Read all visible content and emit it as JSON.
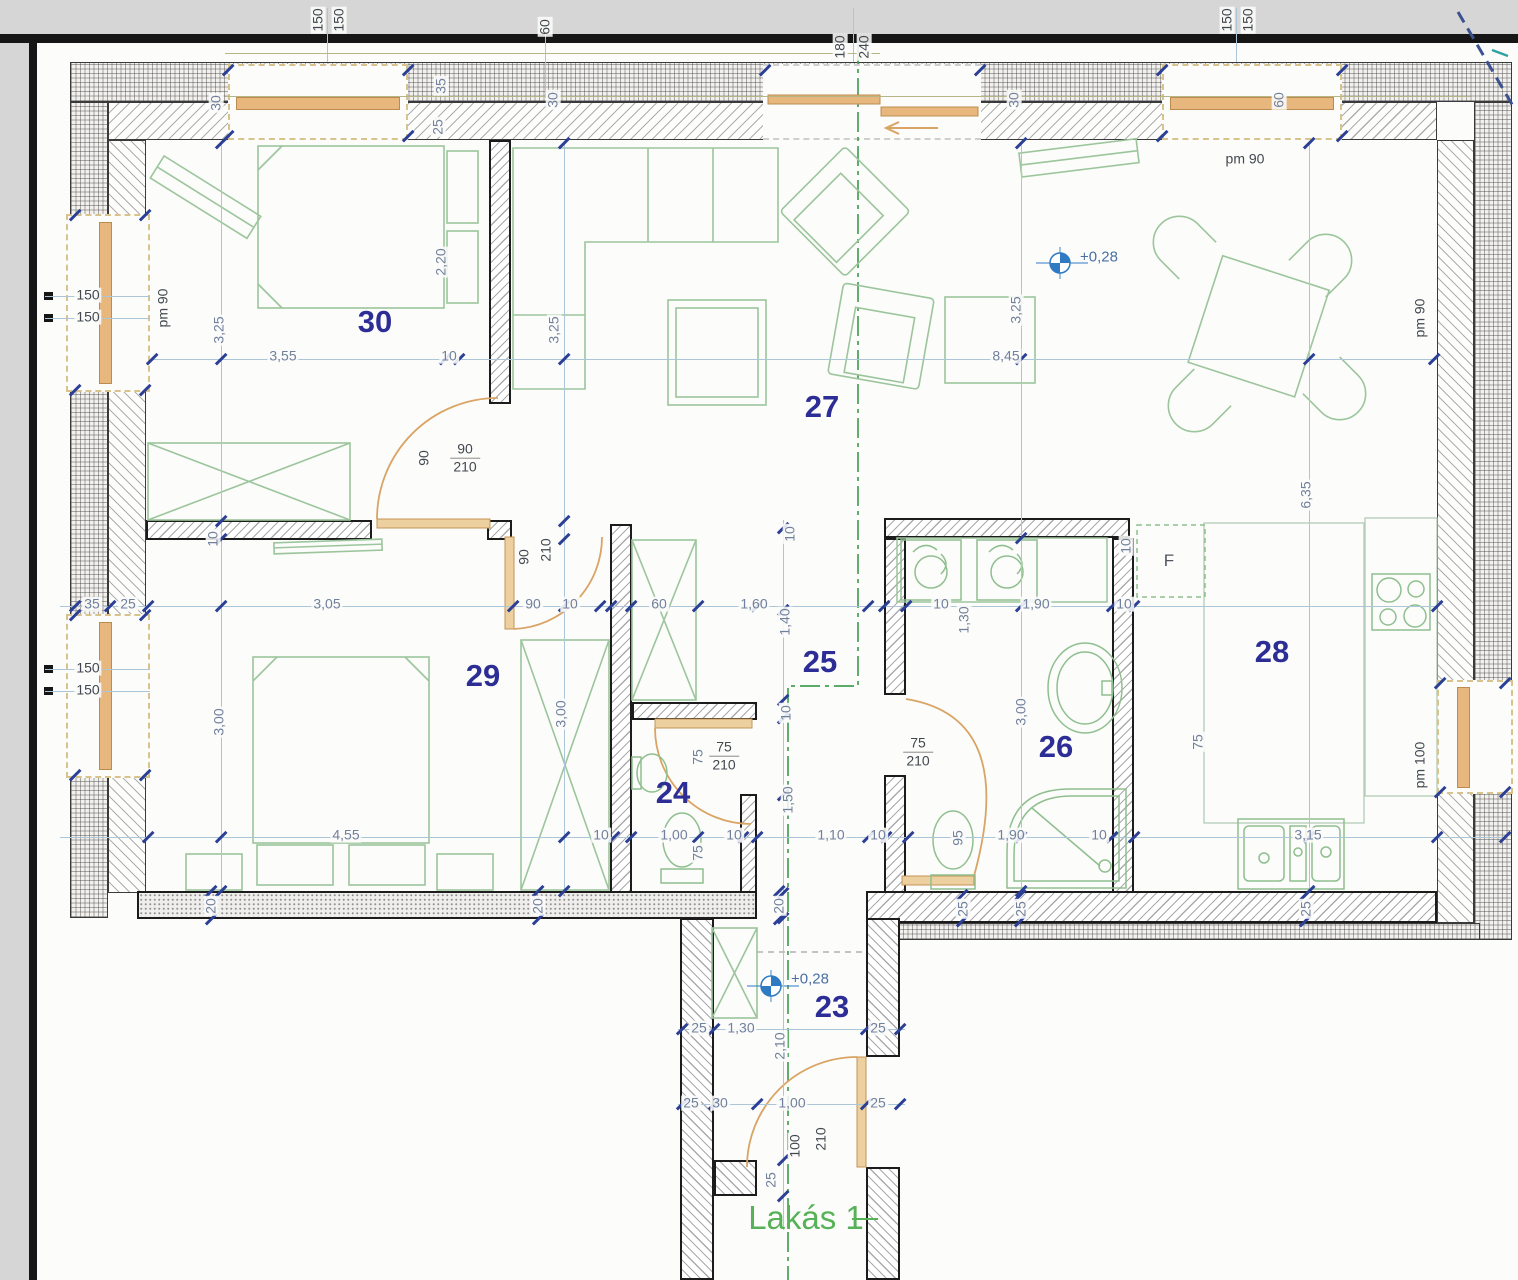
{
  "drawing": {
    "unit_label": "Lakás 1",
    "type": "apartment floor plan",
    "colors": {
      "dim_text": "#71809c",
      "dark_text": "#42484f",
      "room_number": "#2d2d96",
      "green": "#57b257",
      "door_orange": "#d9a464",
      "dim_line": "#aac6d8",
      "tick": "#2b3f96",
      "section_green": "#44a054"
    }
  },
  "rooms": [
    {
      "n": "30",
      "x": 375,
      "y": 322
    },
    {
      "n": "27",
      "x": 822,
      "y": 407
    },
    {
      "n": "29",
      "x": 483,
      "y": 676
    },
    {
      "n": "24",
      "x": 673,
      "y": 793
    },
    {
      "n": "25",
      "x": 820,
      "y": 662
    },
    {
      "n": "26",
      "x": 1056,
      "y": 747
    },
    {
      "n": "28",
      "x": 1272,
      "y": 652
    },
    {
      "n": "23",
      "x": 832,
      "y": 1007
    }
  ],
  "dim_labels": [
    {
      "t": "150",
      "x": 318,
      "y": 20,
      "v": 1,
      "c": "k"
    },
    {
      "t": "150",
      "x": 339,
      "y": 20,
      "v": 1,
      "c": "k"
    },
    {
      "t": "60",
      "x": 545,
      "y": 27,
      "v": 1,
      "c": "k"
    },
    {
      "t": "180",
      "x": 840,
      "y": 47,
      "v": 1,
      "c": "k"
    },
    {
      "t": "240",
      "x": 864,
      "y": 47,
      "v": 1,
      "c": "k"
    },
    {
      "t": "150",
      "x": 1227,
      "y": 20,
      "v": 1,
      "c": "k"
    },
    {
      "t": "150",
      "x": 1248,
      "y": 20,
      "v": 1,
      "c": "k"
    },
    {
      "t": "30",
      "x": 216,
      "y": 103,
      "v": 1
    },
    {
      "t": "35",
      "x": 441,
      "y": 86,
      "v": 1
    },
    {
      "t": "25",
      "x": 438,
      "y": 127,
      "v": 1
    },
    {
      "t": "30",
      "x": 553,
      "y": 100,
      "v": 1
    },
    {
      "t": "30",
      "x": 1014,
      "y": 100,
      "v": 1
    },
    {
      "t": "60",
      "x": 1279,
      "y": 100,
      "v": 1
    },
    {
      "t": "pm 90",
      "x": 1245,
      "y": 159,
      "c": "k"
    },
    {
      "t": "pm 90",
      "x": 163,
      "y": 308,
      "v": 1,
      "c": "k"
    },
    {
      "t": "pm 90",
      "x": 1420,
      "y": 318,
      "v": 1,
      "c": "k"
    },
    {
      "t": "150",
      "x": 88,
      "y": 295,
      "c": "k"
    },
    {
      "t": "150",
      "x": 88,
      "y": 317,
      "c": "k"
    },
    {
      "t": "150",
      "x": 88,
      "y": 668,
      "c": "k"
    },
    {
      "t": "150",
      "x": 88,
      "y": 690,
      "c": "k"
    },
    {
      "t": "3,25",
      "x": 219,
      "y": 330,
      "v": 1
    },
    {
      "t": "3,55",
      "x": 283,
      "y": 356
    },
    {
      "t": "10",
      "x": 449,
      "y": 356
    },
    {
      "t": "3,25",
      "x": 554,
      "y": 330,
      "v": 1
    },
    {
      "t": "8,45",
      "x": 1006,
      "y": 356
    },
    {
      "t": "3,25",
      "x": 1016,
      "y": 310,
      "v": 1
    },
    {
      "t": "2,20",
      "x": 441,
      "y": 262,
      "v": 1
    },
    {
      "t": "6,35",
      "x": 1306,
      "y": 495,
      "v": 1
    },
    {
      "t": "90",
      "x": 424,
      "y": 458,
      "v": 1,
      "c": "k"
    },
    {
      "t": "10",
      "x": 213,
      "y": 539,
      "v": 1
    },
    {
      "t": "90",
      "x": 524,
      "y": 557,
      "v": 1,
      "c": "k"
    },
    {
      "t": "210",
      "x": 546,
      "y": 550,
      "v": 1,
      "c": "k"
    },
    {
      "t": "35",
      "x": 92,
      "y": 604
    },
    {
      "t": "25",
      "x": 128,
      "y": 604
    },
    {
      "t": "3,05",
      "x": 327,
      "y": 604
    },
    {
      "t": "90",
      "x": 533,
      "y": 604
    },
    {
      "t": "10",
      "x": 570,
      "y": 604
    },
    {
      "t": "60",
      "x": 659,
      "y": 604
    },
    {
      "t": "1,60",
      "x": 754,
      "y": 604
    },
    {
      "t": "10",
      "x": 790,
      "y": 534,
      "v": 1
    },
    {
      "t": "1,40",
      "x": 785,
      "y": 622,
      "v": 1
    },
    {
      "t": "10",
      "x": 941,
      "y": 604
    },
    {
      "t": "1,30",
      "x": 964,
      "y": 620,
      "v": 1
    },
    {
      "t": "1,90",
      "x": 1036,
      "y": 604
    },
    {
      "t": "10",
      "x": 1124,
      "y": 604
    },
    {
      "t": "10",
      "x": 1126,
      "y": 546,
      "v": 1
    },
    {
      "t": "F",
      "x": 1169,
      "y": 561,
      "c": "k",
      "cls": "flabel"
    },
    {
      "t": "3,00",
      "x": 219,
      "y": 722,
      "v": 1
    },
    {
      "t": "3,00",
      "x": 561,
      "y": 714,
      "v": 1
    },
    {
      "t": "3,00",
      "x": 1021,
      "y": 712,
      "v": 1
    },
    {
      "t": "10",
      "x": 786,
      "y": 713,
      "v": 1
    },
    {
      "t": "75",
      "x": 698,
      "y": 757,
      "v": 1
    },
    {
      "t": "1,50",
      "x": 788,
      "y": 800,
      "v": 1
    },
    {
      "t": "75",
      "x": 1198,
      "y": 742,
      "v": 1
    },
    {
      "t": "4,55",
      "x": 346,
      "y": 835
    },
    {
      "t": "10",
      "x": 601,
      "y": 835
    },
    {
      "t": "1,00",
      "x": 674,
      "y": 835
    },
    {
      "t": "10",
      "x": 734,
      "y": 835
    },
    {
      "t": "1,10",
      "x": 831,
      "y": 835
    },
    {
      "t": "10",
      "x": 878,
      "y": 835
    },
    {
      "t": "95",
      "x": 958,
      "y": 838,
      "v": 1
    },
    {
      "t": "1,90",
      "x": 1011,
      "y": 835
    },
    {
      "t": "10",
      "x": 1099,
      "y": 835
    },
    {
      "t": "3,15",
      "x": 1308,
      "y": 835
    },
    {
      "t": "75",
      "x": 698,
      "y": 853,
      "v": 1
    },
    {
      "t": "20",
      "x": 211,
      "y": 906,
      "v": 1
    },
    {
      "t": "20",
      "x": 538,
      "y": 906,
      "v": 1
    },
    {
      "t": "20",
      "x": 779,
      "y": 906,
      "v": 1
    },
    {
      "t": "25",
      "x": 963,
      "y": 909,
      "v": 1
    },
    {
      "t": "25",
      "x": 1021,
      "y": 909,
      "v": 1
    },
    {
      "t": "25",
      "x": 1306,
      "y": 909,
      "v": 1
    },
    {
      "t": "pm 100",
      "x": 1420,
      "y": 765,
      "v": 1,
      "c": "k"
    },
    {
      "t": "25",
      "x": 699,
      "y": 1028
    },
    {
      "t": "1,30",
      "x": 741,
      "y": 1028
    },
    {
      "t": "25",
      "x": 878,
      "y": 1028
    },
    {
      "t": "2,10",
      "x": 780,
      "y": 1046,
      "v": 1
    },
    {
      "t": "25",
      "x": 691,
      "y": 1103
    },
    {
      "t": "30",
      "x": 720,
      "y": 1103
    },
    {
      "t": "1,00",
      "x": 792,
      "y": 1103
    },
    {
      "t": "25",
      "x": 878,
      "y": 1103
    },
    {
      "t": "100",
      "x": 795,
      "y": 1146,
      "v": 1,
      "c": "k"
    },
    {
      "t": "210",
      "x": 821,
      "y": 1139,
      "v": 1,
      "c": "k"
    },
    {
      "t": "25",
      "x": 771,
      "y": 1180,
      "v": 1
    }
  ],
  "frac_labels": [
    {
      "top": "90",
      "bottom": "210",
      "x": 465,
      "y": 458
    },
    {
      "top": "75",
      "bottom": "210",
      "x": 724,
      "y": 756
    },
    {
      "top": "75",
      "bottom": "210",
      "x": 918,
      "y": 752
    }
  ],
  "elevation_markers": [
    {
      "label": "+0,28",
      "x": 1060,
      "y": 263,
      "tx": 1080,
      "ty": 257
    },
    {
      "label": "+0,28",
      "x": 771,
      "y": 986,
      "tx": 791,
      "ty": 979
    }
  ],
  "green_labels": [
    {
      "t": "Lakás 1",
      "x": 806,
      "y": 1218
    }
  ],
  "dim_lines": [
    [
      150,
      359,
      1287,
      1
    ],
    [
      60,
      606,
      1377,
      1
    ],
    [
      60,
      837,
      1447,
      1
    ],
    [
      678,
      1029,
      227,
      1
    ],
    [
      678,
      1104,
      227,
      1
    ],
    [
      221,
      143,
      1,
      748
    ],
    [
      564,
      143,
      1,
      748
    ],
    [
      1021,
      143,
      1,
      748
    ],
    [
      1309,
      143,
      1,
      748
    ],
    [
      783,
      520,
      1,
      710
    ],
    [
      45,
      296,
      105,
      1
    ],
    [
      45,
      318,
      105,
      1
    ],
    [
      45,
      669,
      105,
      1
    ],
    [
      45,
      691,
      105,
      1
    ],
    [
      327,
      8,
      1,
      54
    ],
    [
      1236,
      8,
      1,
      54
    ],
    [
      853,
      8,
      1,
      54
    ],
    [
      545,
      18,
      1,
      80
    ],
    [
      225,
      96,
      1245,
      1,
      "#b5b585"
    ],
    [
      225,
      53,
      655,
      1,
      "#b5b585"
    ],
    [
      852,
      1218,
      26,
      1.5,
      "#57b257"
    ]
  ],
  "ticks": [
    [
      152,
      359
    ],
    [
      445,
      359
    ],
    [
      459,
      359
    ],
    [
      1434,
      359
    ],
    [
      75,
      606
    ],
    [
      110,
      606
    ],
    [
      148,
      606
    ],
    [
      513,
      606
    ],
    [
      600,
      606
    ],
    [
      611,
      606
    ],
    [
      631,
      606
    ],
    [
      698,
      606
    ],
    [
      757,
      606
    ],
    [
      868,
      606
    ],
    [
      884,
      606
    ],
    [
      906,
      606
    ],
    [
      1112,
      606
    ],
    [
      1134,
      606
    ],
    [
      1437,
      606
    ],
    [
      148,
      837
    ],
    [
      614,
      837
    ],
    [
      631,
      837
    ],
    [
      698,
      837
    ],
    [
      743,
      837
    ],
    [
      757,
      837
    ],
    [
      868,
      837
    ],
    [
      886,
      837
    ],
    [
      908,
      837
    ],
    [
      1112,
      837
    ],
    [
      1134,
      837
    ],
    [
      1437,
      837
    ],
    [
      1505,
      837
    ],
    [
      221,
      143
    ],
    [
      221,
      359
    ],
    [
      221,
      521
    ],
    [
      221,
      539
    ],
    [
      221,
      606
    ],
    [
      221,
      837
    ],
    [
      221,
      891
    ],
    [
      564,
      143
    ],
    [
      564,
      359
    ],
    [
      564,
      521
    ],
    [
      564,
      539
    ],
    [
      564,
      606
    ],
    [
      564,
      837
    ],
    [
      564,
      891
    ],
    [
      1021,
      143
    ],
    [
      1021,
      359
    ],
    [
      1021,
      538
    ],
    [
      1021,
      606
    ],
    [
      1021,
      837
    ],
    [
      1021,
      891
    ],
    [
      1309,
      143
    ],
    [
      1309,
      359
    ],
    [
      1309,
      837
    ],
    [
      1309,
      891
    ],
    [
      783,
      528
    ],
    [
      783,
      610
    ],
    [
      783,
      700
    ],
    [
      783,
      718
    ],
    [
      783,
      795
    ],
    [
      783,
      893
    ],
    [
      783,
      918
    ],
    [
      783,
      1160
    ],
    [
      783,
      1196
    ],
    [
      682,
      1029
    ],
    [
      714,
      1029
    ],
    [
      866,
      1029
    ],
    [
      900,
      1029
    ],
    [
      682,
      1104
    ],
    [
      714,
      1104
    ],
    [
      757,
      1104
    ],
    [
      866,
      1104
    ],
    [
      900,
      1104
    ],
    [
      228,
      70
    ],
    [
      408,
      70
    ],
    [
      228,
      136
    ],
    [
      408,
      136
    ],
    [
      1162,
      70
    ],
    [
      1342,
      70
    ],
    [
      1162,
      136
    ],
    [
      1342,
      136
    ],
    [
      765,
      70
    ],
    [
      980,
      70
    ],
    [
      75,
      215
    ],
    [
      145,
      215
    ],
    [
      75,
      390
    ],
    [
      145,
      390
    ],
    [
      75,
      615
    ],
    [
      145,
      615
    ],
    [
      75,
      775
    ],
    [
      145,
      775
    ],
    [
      1440,
      683
    ],
    [
      1440,
      792
    ],
    [
      1505,
      683
    ],
    [
      1505,
      792
    ],
    [
      211,
      891
    ],
    [
      211,
      919
    ],
    [
      538,
      891
    ],
    [
      538,
      919
    ],
    [
      779,
      891
    ],
    [
      779,
      919
    ],
    [
      962,
      895
    ],
    [
      962,
      921
    ],
    [
      1020,
      895
    ],
    [
      1020,
      921
    ],
    [
      1305,
      895
    ],
    [
      1305,
      921
    ]
  ]
}
